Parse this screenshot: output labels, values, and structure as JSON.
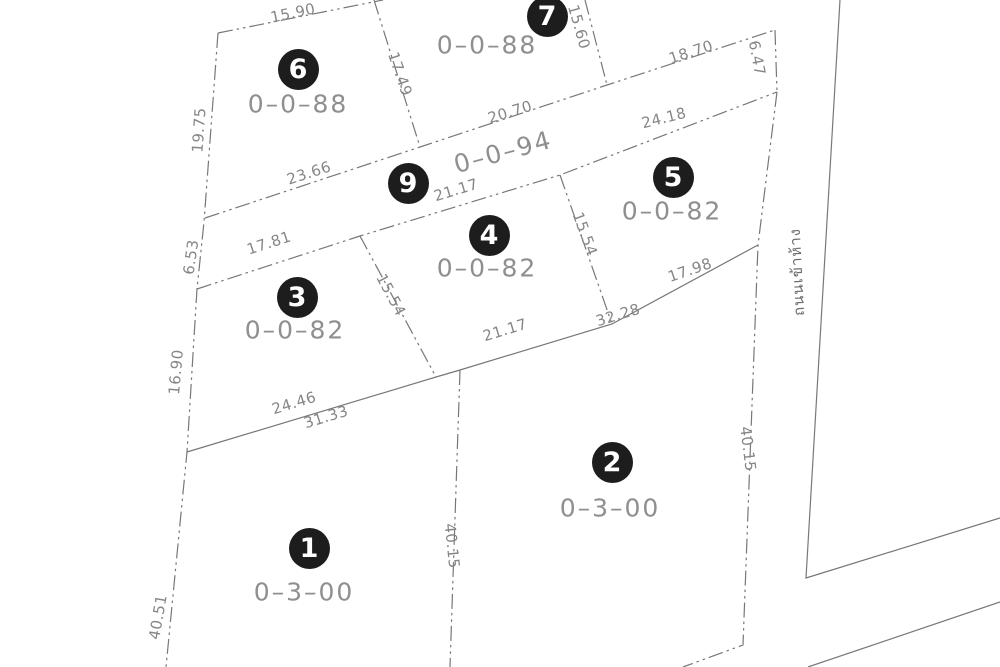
{
  "drawing": {
    "type": "land-subdivision-survey-plan",
    "background_color": "#ffffff",
    "line_color": "#777777",
    "label_color": "#868686",
    "circle_color": "#1d1d1d",
    "road_label": {
      "text": "ถนนเข้าห้าง",
      "x": 797,
      "y": 272,
      "rot": -93
    },
    "plots": [
      {
        "number": "6",
        "area": "0–0–88",
        "circle": {
          "x": 298,
          "y": 69
        },
        "area_label": {
          "x": 298,
          "y": 104,
          "rot": 0
        }
      },
      {
        "number": "7",
        "area": "0–0–88",
        "circle": {
          "x": 547,
          "y": 16
        },
        "area_label": {
          "x": 487,
          "y": 45,
          "rot": 0
        }
      },
      {
        "number": "9",
        "area": "0–0–94",
        "circle": {
          "x": 408,
          "y": 183
        },
        "area_label": {
          "x": 503,
          "y": 152,
          "rot": -15
        }
      },
      {
        "number": "5",
        "area": "0–0–82",
        "circle": {
          "x": 673,
          "y": 177
        },
        "area_label": {
          "x": 672,
          "y": 211,
          "rot": 0
        }
      },
      {
        "number": "4",
        "area": "0–0–82",
        "circle": {
          "x": 489,
          "y": 235
        },
        "area_label": {
          "x": 487,
          "y": 268,
          "rot": 0
        }
      },
      {
        "number": "3",
        "area": "0–0–82",
        "circle": {
          "x": 297,
          "y": 297
        },
        "area_label": {
          "x": 295,
          "y": 330,
          "rot": 0
        }
      },
      {
        "number": "2",
        "area": "0–3–00",
        "circle": {
          "x": 612,
          "y": 462
        },
        "area_label": {
          "x": 610,
          "y": 508,
          "rot": 0
        }
      },
      {
        "number": "1",
        "area": "0–3–00",
        "circle": {
          "x": 309,
          "y": 548
        },
        "area_label": {
          "x": 304,
          "y": 592,
          "rot": 0
        }
      }
    ],
    "dimension_labels": [
      {
        "text": "15.90",
        "x": 293,
        "y": 13,
        "rot": -12
      },
      {
        "text": "19.75",
        "x": 199,
        "y": 130,
        "rot": -86
      },
      {
        "text": "6.53",
        "x": 191,
        "y": 257,
        "rot": -82
      },
      {
        "text": "16.90",
        "x": 176,
        "y": 372,
        "rot": -85
      },
      {
        "text": "40.51",
        "x": 158,
        "y": 617,
        "rot": -80
      },
      {
        "text": "17.49",
        "x": 400,
        "y": 74,
        "rot": 71
      },
      {
        "text": "15.60",
        "x": 579,
        "y": 27,
        "rot": 74
      },
      {
        "text": "23.66",
        "x": 309,
        "y": 173,
        "rot": -18
      },
      {
        "text": "20.70",
        "x": 510,
        "y": 112,
        "rot": -17
      },
      {
        "text": "18.70",
        "x": 691,
        "y": 52,
        "rot": -18
      },
      {
        "text": "6.47",
        "x": 757,
        "y": 58,
        "rot": 79
      },
      {
        "text": "24.18",
        "x": 664,
        "y": 118,
        "rot": -14
      },
      {
        "text": "21.17",
        "x": 456,
        "y": 190,
        "rot": -17
      },
      {
        "text": "17.81",
        "x": 269,
        "y": 243,
        "rot": -18
      },
      {
        "text": "15.54",
        "x": 391,
        "y": 295,
        "rot": 62
      },
      {
        "text": "15.54",
        "x": 585,
        "y": 234,
        "rot": 70
      },
      {
        "text": "17.98",
        "x": 690,
        "y": 270,
        "rot": -19
      },
      {
        "text": "32.28",
        "x": 618,
        "y": 315,
        "rot": -17
      },
      {
        "text": "21.17",
        "x": 505,
        "y": 330,
        "rot": -17
      },
      {
        "text": "24.46",
        "x": 294,
        "y": 403,
        "rot": -17
      },
      {
        "text": "31.33",
        "x": 326,
        "y": 417,
        "rot": -17
      },
      {
        "text": "40.15",
        "x": 452,
        "y": 546,
        "rot": 84
      },
      {
        "text": "40.15",
        "x": 748,
        "y": 449,
        "rot": 83
      }
    ]
  }
}
